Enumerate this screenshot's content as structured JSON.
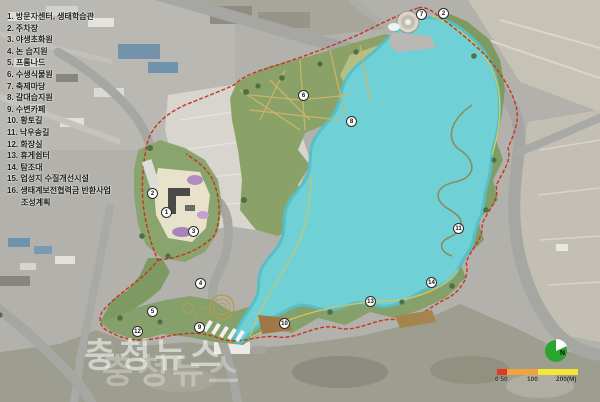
{
  "legend": {
    "items": [
      {
        "text": "1. 방문자센터, 생태학습관",
        "indent": false
      },
      {
        "text": "2. 주차장",
        "indent": false
      },
      {
        "text": "3. 야생초화원",
        "indent": false
      },
      {
        "text": "4. 논 습지원",
        "indent": false
      },
      {
        "text": "5. 프롬나드",
        "indent": false
      },
      {
        "text": "6. 수생식물원",
        "indent": false
      },
      {
        "text": "7. 축제마당",
        "indent": false
      },
      {
        "text": "8. 갈대습지원",
        "indent": false
      },
      {
        "text": "9. 수변카페",
        "indent": false
      },
      {
        "text": "10. 황토길",
        "indent": false
      },
      {
        "text": "11. 낙우송길",
        "indent": false
      },
      {
        "text": "12. 화장실",
        "indent": false
      },
      {
        "text": "13. 휴게쉼터",
        "indent": false
      },
      {
        "text": "14. 탐조대",
        "indent": false
      },
      {
        "text": "15. 업성지 수질개선시설",
        "indent": false
      },
      {
        "text": "16. 생태계보전협력금 반환사업",
        "indent": false
      },
      {
        "text": "조성계획",
        "indent": true
      }
    ]
  },
  "markers": [
    {
      "n": 1,
      "x": 166,
      "y": 212
    },
    {
      "n": 2,
      "x": 152,
      "y": 193
    },
    {
      "n": 3,
      "x": 193,
      "y": 231
    },
    {
      "n": 4,
      "x": 200,
      "y": 283
    },
    {
      "n": 5,
      "x": 152,
      "y": 311
    },
    {
      "n": 6,
      "x": 303,
      "y": 95
    },
    {
      "n": 7,
      "x": 421,
      "y": 14
    },
    {
      "n": 2,
      "x": 443,
      "y": 13
    },
    {
      "n": 8,
      "x": 351,
      "y": 121
    },
    {
      "n": 9,
      "x": 199,
      "y": 327
    },
    {
      "n": 10,
      "x": 284,
      "y": 323
    },
    {
      "n": 11,
      "x": 458,
      "y": 228
    },
    {
      "n": 12,
      "x": 137,
      "y": 331
    },
    {
      "n": 13,
      "x": 370,
      "y": 301
    },
    {
      "n": 14,
      "x": 431,
      "y": 282
    }
  ],
  "watermark": {
    "text": "충청뉴스"
  },
  "scale_bar": {
    "ticks": [
      "0 50",
      "100",
      "200(M)"
    ],
    "segment_colors": [
      "#e03a20",
      "#f2a340",
      "#f5e733"
    ]
  },
  "north_symbol": {
    "label": "N",
    "color": "#2aa52e"
  },
  "colors": {
    "lake": "#6fd0d6",
    "lake_edge": "#57bfc6",
    "park_green": "#85a06a",
    "park_green_dark": "#7d9a63",
    "meadow": "#bcc489",
    "bare_field": "#d7d5cd",
    "road": "#a6a6a3",
    "boundary_red": "#c83420",
    "trail_yellow": "#c9b469",
    "plaza_beige": "#e9e2ca",
    "aerial_base": "#b3b1ab"
  }
}
